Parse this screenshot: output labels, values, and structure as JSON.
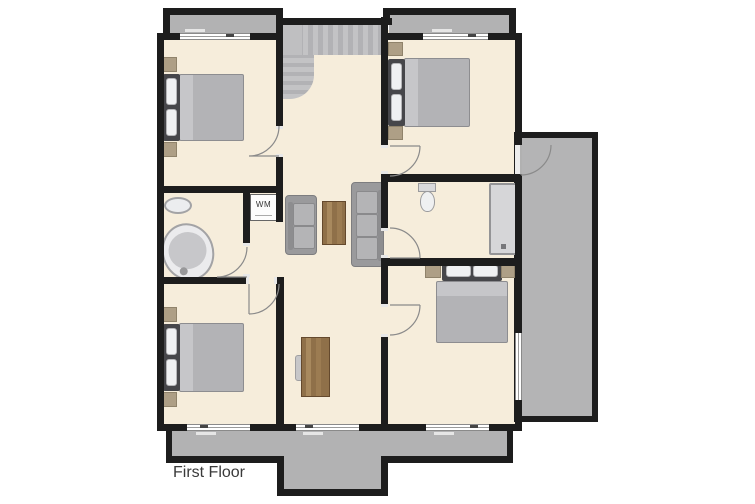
{
  "plan": {
    "title": "First Floor",
    "washer_label": "WM"
  },
  "colors": {
    "wall": "#1d1d1d",
    "floor": "#f6eddb",
    "roof_dormer_area": "#b2b2b3",
    "stairs": "#bcbcbe",
    "duvet": "#b3b3b6",
    "pillow": "#eff0f2",
    "nightstand": "#ae9f86",
    "sofa": "#9a9a9c",
    "wood_furniture": "#8f7049",
    "sanitary_fixture": "#ebebed",
    "door_swing": "#8a8a8a",
    "background": "#ffffff"
  },
  "icons": {
    "double_bed": 4,
    "nightstand": 8,
    "sofa": 2,
    "coffee_table": 1,
    "desk_with_chair": 1,
    "bathtub": 1,
    "washbasin": 1,
    "toilet": 1,
    "shower": 1,
    "washing_machine": 1,
    "staircase": 1,
    "door_swing": 7,
    "window": 6
  }
}
